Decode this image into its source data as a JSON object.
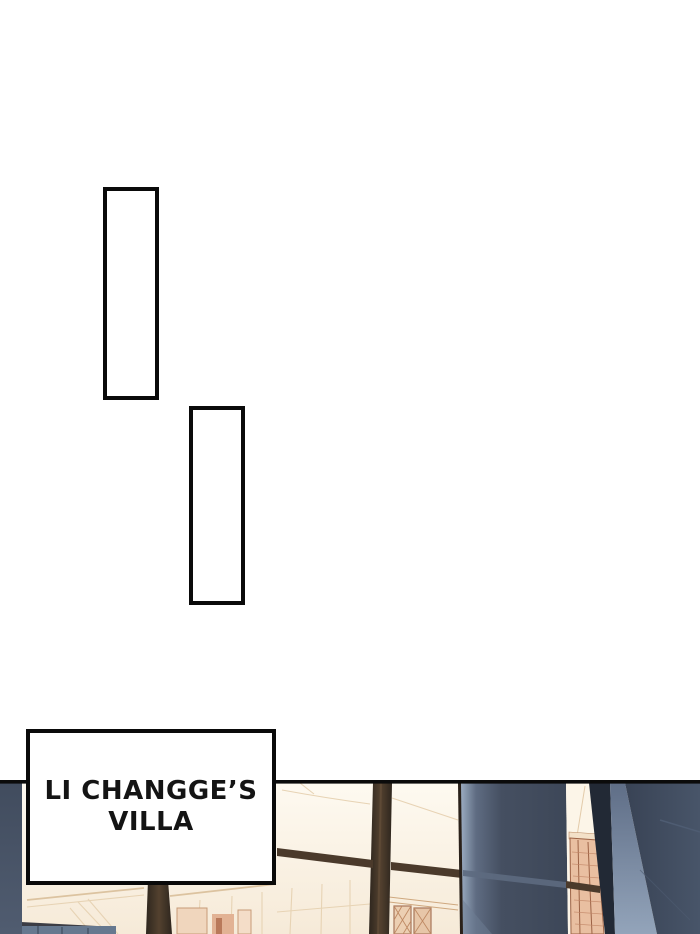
{
  "page": {
    "background": "#ffffff",
    "ink": "#0b0b0b"
  },
  "balloons": [
    {
      "shape": "tall-rectangle",
      "text": ""
    },
    {
      "shape": "tall-rectangle",
      "text": ""
    }
  ],
  "caption": {
    "line1": "LI CHANGGE’S",
    "line2": "VILLA",
    "text_color": "#141414"
  },
  "scene": {
    "label": "villa interior with tall sunlit windows",
    "colors": {
      "ink": "#0b0b0b",
      "cream": "#fcf5e8",
      "slate_left": "#465163",
      "slate_deep": "#222935",
      "frame_brown": "#2a211a",
      "mullion_brown": "#4b3a2b",
      "door_tan": "#e9bfa1",
      "door_line": "#9c6245",
      "panel_tan": "#eccfb2",
      "panel_line": "#a8765a"
    }
  }
}
